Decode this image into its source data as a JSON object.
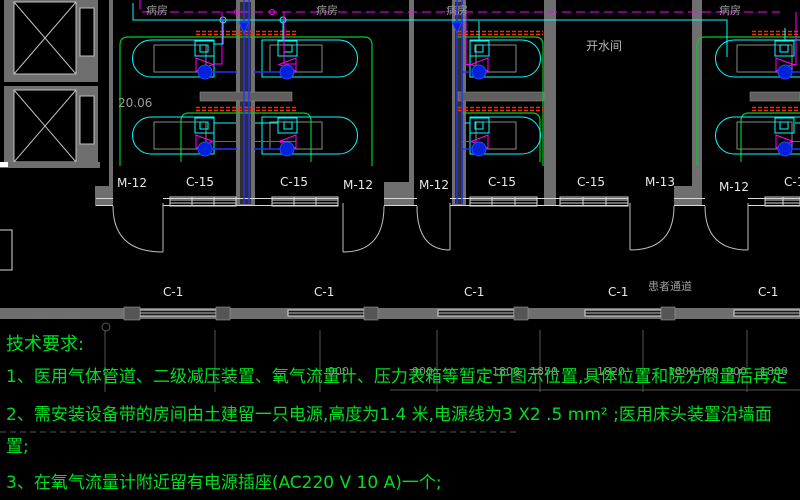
{
  "canvas": {
    "w": 800,
    "h": 500
  },
  "colors": {
    "background": "#000000",
    "pipe_magenta": "#ff00ff",
    "pipe_cyan": "#00ffff",
    "pipe_blue": "#2233ff",
    "equipment_belt_red": "#ff2a00",
    "room_outline_green": "#00cc22",
    "notes_green": "#00dd22",
    "wall_gray": "#6f6f6f",
    "label_white": "#e8e8e8",
    "label_gray": "#9a9a9a"
  },
  "plan": {
    "elevation_text": "20.06",
    "hot_water_room_label": "开水间",
    "corridor_name": "患者通道",
    "room_labels": [
      {
        "t": "病房",
        "x": 146,
        "y": 5
      },
      {
        "t": "病房",
        "x": 316,
        "y": 5
      },
      {
        "t": "病房",
        "x": 446,
        "y": 5
      },
      {
        "t": "病房",
        "x": 719,
        "y": 5
      }
    ],
    "door_window_labels": [
      {
        "t": "M-12",
        "x": 117,
        "y": 177
      },
      {
        "t": "C-15",
        "x": 186,
        "y": 176
      },
      {
        "t": "C-15",
        "x": 280,
        "y": 176
      },
      {
        "t": "M-12",
        "x": 343,
        "y": 179
      },
      {
        "t": "M-12",
        "x": 419,
        "y": 179
      },
      {
        "t": "C-15",
        "x": 488,
        "y": 176
      },
      {
        "t": "C-15",
        "x": 577,
        "y": 176
      },
      {
        "t": "M-13",
        "x": 645,
        "y": 176
      },
      {
        "t": "M-12",
        "x": 719,
        "y": 181
      },
      {
        "t": "C-1",
        "x": 784,
        "y": 176
      }
    ],
    "corridor_labels": [
      {
        "t": "C-1",
        "x": 163,
        "y": 286
      },
      {
        "t": "C-1",
        "x": 314,
        "y": 286
      },
      {
        "t": "C-1",
        "x": 464,
        "y": 286
      },
      {
        "t": "C-1",
        "x": 608,
        "y": 286
      },
      {
        "t": "C-1",
        "x": 758,
        "y": 286
      }
    ]
  },
  "dimensions": {
    "numbers": [
      {
        "t": "900",
        "x": 328,
        "y": 366
      },
      {
        "t": "900",
        "x": 412,
        "y": 366
      },
      {
        "t": "1800",
        "x": 492,
        "y": 366
      },
      {
        "t": "1850",
        "x": 530,
        "y": 366
      },
      {
        "t": "1820",
        "x": 597,
        "y": 366
      },
      {
        "t": "1800",
        "x": 668,
        "y": 366
      },
      {
        "t": "900",
        "x": 698,
        "y": 366
      },
      {
        "t": "900",
        "x": 726,
        "y": 366
      },
      {
        "t": "1800",
        "x": 760,
        "y": 366
      }
    ]
  },
  "notes": {
    "title": "技术要求:",
    "line1": "1、医用气体管道、二级减压装置、氧气流量计、压力表箱等暂定于图示位置,具体位置和院方商量后再定",
    "line2": "2、需安装设备带的房间由土建留一只电源,高度为1.4 米,电源线为3 X2 .5 mm² ;医用床头装置沿墙面",
    "line2_wrap": "置;",
    "line3": "3、在氧气流量计附近留有电源插座(AC220 V 10 A)一个;"
  }
}
